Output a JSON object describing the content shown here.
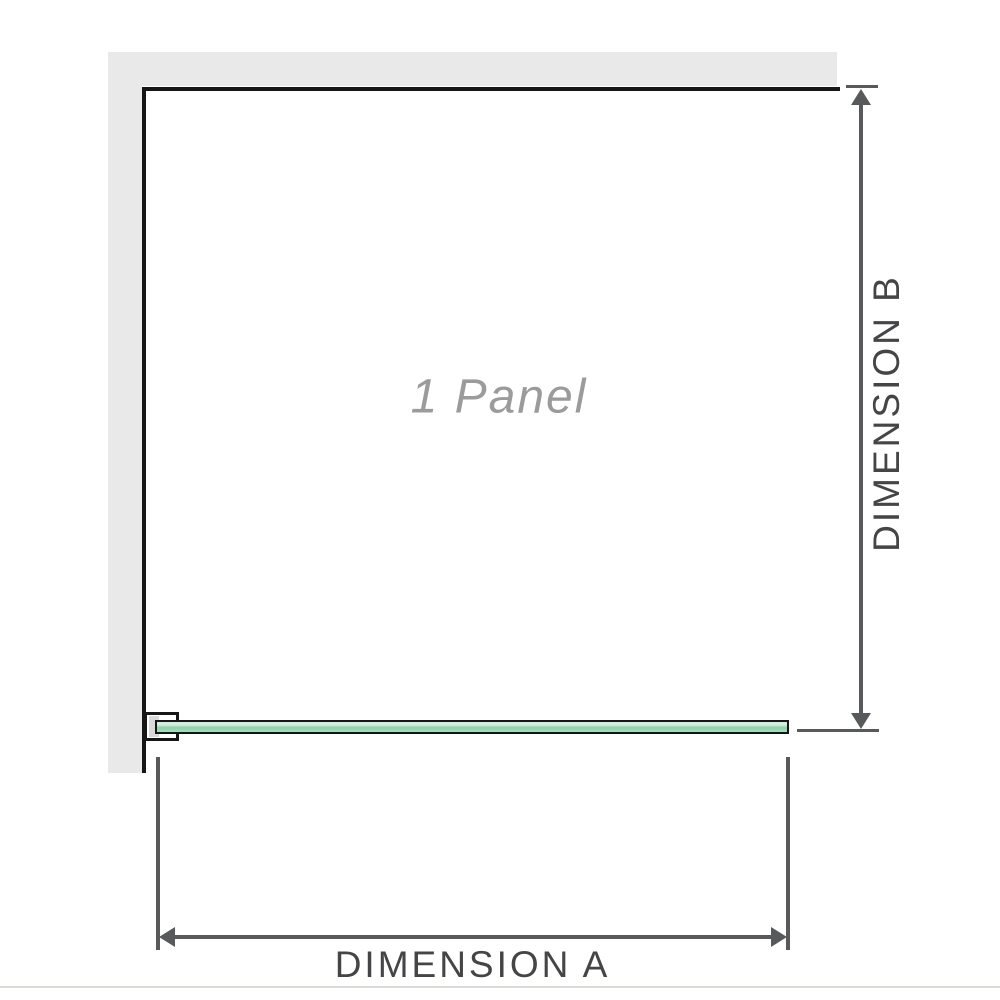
{
  "diagram": {
    "panel_label": "1 Panel",
    "dimension_a_label": "DIMENSION A",
    "dimension_b_label": "DIMENSION B"
  },
  "colors": {
    "glass_green": "#8fd0a9",
    "glass_green_mid": "#a8debd",
    "glass_green_light": "#d2eedd",
    "wall_gray": "#e9e9e9",
    "outline_black": "#161616",
    "dimension_gray": "#58595b",
    "label_gray": "#9b9b9b",
    "divider_gray": "#dcdcd6"
  }
}
